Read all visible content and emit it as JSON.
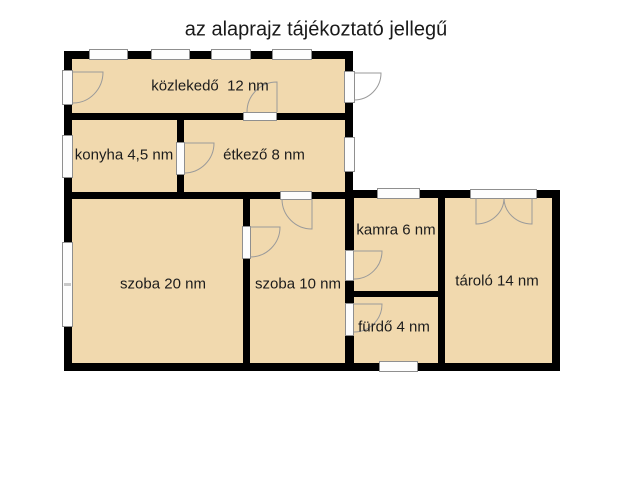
{
  "title": "az alaprajz tájékoztató jellegű",
  "rooms": {
    "kozlekedo": {
      "label": "közlekedő  12 nm",
      "name": "közlekedő",
      "area": "12 nm"
    },
    "konyha": {
      "label": "konyha 4,5 nm",
      "name": "konyha",
      "area": "4,5 nm"
    },
    "etkezo": {
      "label": "étkező 8 nm",
      "name": "étkező",
      "area": "8 nm"
    },
    "szoba20": {
      "label": "szoba 20 nm",
      "name": "szoba",
      "area": "20 nm"
    },
    "szoba10": {
      "label": "szoba 10 nm",
      "name": "szoba",
      "area": "10 nm"
    },
    "kamra": {
      "label": "kamra 6 nm",
      "name": "kamra",
      "area": "6 nm"
    },
    "furdo": {
      "label": "fürdő 4 nm",
      "name": "fürdő",
      "area": "4 nm"
    },
    "tarolo": {
      "label": "tároló 14 nm",
      "name": "tároló",
      "area": "14 nm"
    }
  },
  "colors": {
    "background": "#ffffff",
    "room_fill": "#F1D9AE",
    "wall": "#000000",
    "opening_fill": "#fdfdfd",
    "opening_border": "#8f8f8f",
    "door_arc": "#9a9a9a",
    "text": "#1a1a1a"
  }
}
